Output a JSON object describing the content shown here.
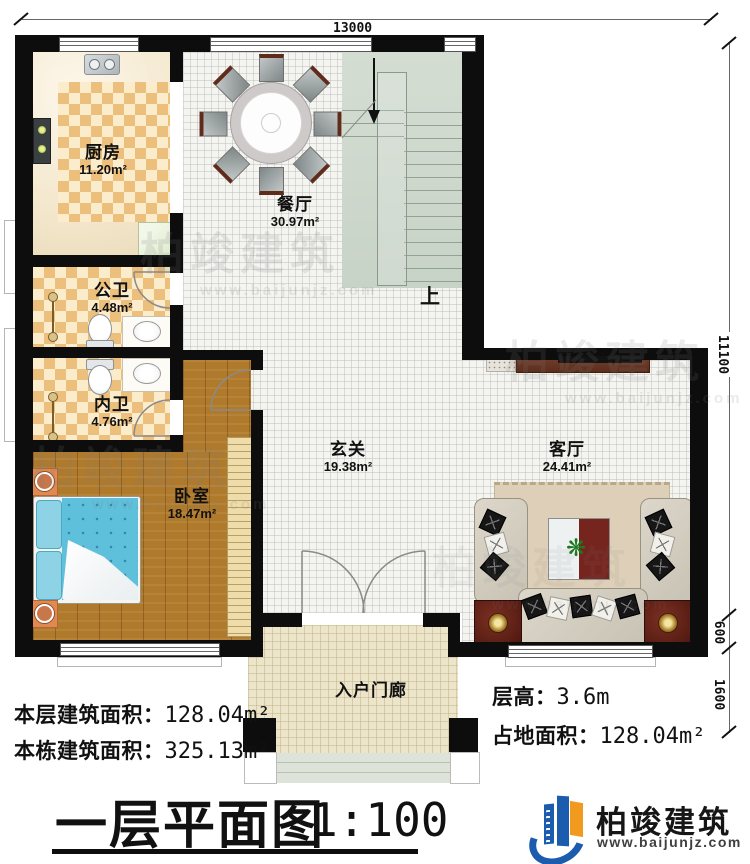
{
  "dimensions": {
    "top_width": "13000",
    "right_total": "11100",
    "right_seg_small": "600",
    "right_seg_large": "1600"
  },
  "rooms": {
    "kitchen": {
      "name": "厨房",
      "area": "11.20m²"
    },
    "dining": {
      "name": "餐厅",
      "area": "30.97m²"
    },
    "public_bath": {
      "name": "公卫",
      "area": "4.48m²"
    },
    "inner_bath": {
      "name": "内卫",
      "area": "4.76m²"
    },
    "bedroom": {
      "name": "卧室",
      "area": "18.47m²"
    },
    "foyer": {
      "name": "玄关",
      "area": "19.38m²"
    },
    "living": {
      "name": "客厅",
      "area": "24.41m²"
    },
    "porch": {
      "name": "入户门廊"
    }
  },
  "stairs": {
    "up_label": "上"
  },
  "info": {
    "floor_area_label": "本层建筑面积：",
    "floor_area_value": "128.04m²",
    "building_area_label": "本栋建筑面积：",
    "building_area_value": "325.13m²",
    "height_label": "层高：",
    "height_value": "3.6m",
    "footprint_label": "占地面积：",
    "footprint_value": "128.04m²"
  },
  "title": {
    "main": "一层平面图",
    "scale": "1:100"
  },
  "brand": {
    "name": "柏竣建筑",
    "url": "www.baijunjz.com"
  },
  "watermark": {
    "text": "柏竣建筑",
    "url": "www.baijunjz.com"
  },
  "colors": {
    "wall": "#0d0d0d",
    "wood_floor": "#b07a2c",
    "checker_tile": "#edbf7c",
    "stairs": "#cfd9ce",
    "logo_blue": "#1c5cae",
    "logo_orange": "#f29a1e"
  }
}
